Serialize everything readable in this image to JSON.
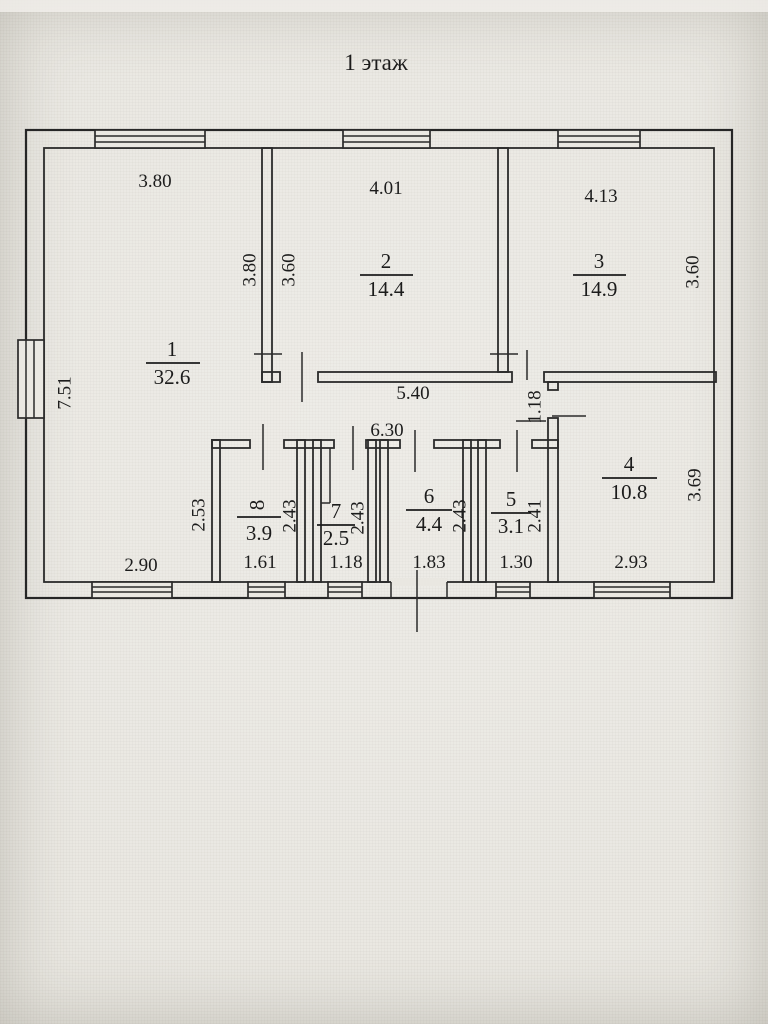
{
  "title": "1 этаж",
  "colors": {
    "paper": "#e9e7e1",
    "ink": "#2b2b2b"
  },
  "rooms": {
    "r1": {
      "number": "1",
      "area": "32.6"
    },
    "r2": {
      "number": "2",
      "area": "14.4"
    },
    "r3": {
      "number": "3",
      "area": "14.9"
    },
    "r4": {
      "number": "4",
      "area": "10.8"
    },
    "r5": {
      "number": "5",
      "area": "3.1"
    },
    "r6": {
      "number": "6",
      "area": "4.4"
    },
    "r7": {
      "number": "7",
      "area": "2.5"
    },
    "r8": {
      "number": "8",
      "area": "3.9"
    }
  },
  "dims": {
    "top_room1": "3.80",
    "top_room2": "4.01",
    "top_room3": "4.13",
    "left_outer": "7.51",
    "room1_right": "3.80",
    "room2_left": "3.60",
    "room3_right": "3.60",
    "hall_width": "5.40",
    "corridor_width": "6.30",
    "passage_room4": "1.18",
    "room4_right": "3.69",
    "room4_bottom": "2.93",
    "room1_bottom": "2.90",
    "room8_outer_left": "2.53",
    "room8_right": "2.43",
    "room8_bottom": "1.61",
    "room7_right": "2.43",
    "room7_bottom": "1.18",
    "room6_right": "2.43",
    "room6_bottom": "1.83",
    "room5_right": "2.41",
    "room5_bottom": "1.30"
  }
}
